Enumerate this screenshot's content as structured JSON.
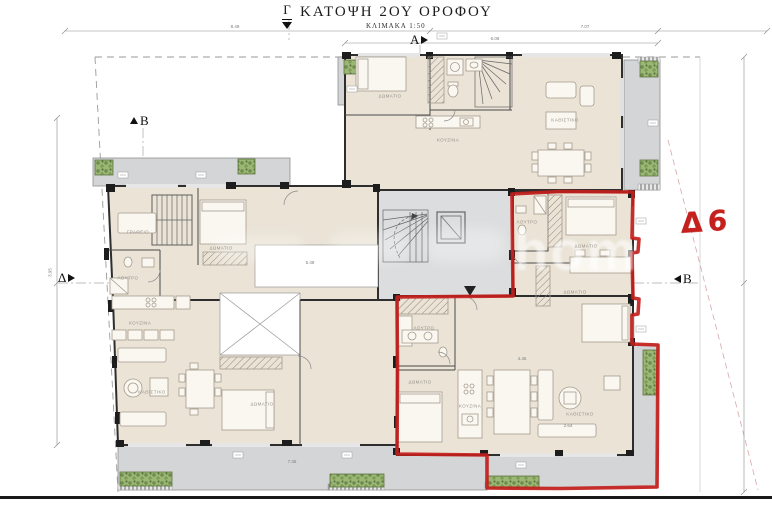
{
  "title": {
    "main": "ΚΑΤΟΨΗ 2ΟΥ ΟΡΟΦΟΥ",
    "scale": "ΚΛΙΜΑΚΑ 1:50"
  },
  "unit_label": "Δ6",
  "watermark": "home",
  "colors": {
    "highlight": "#c4201d",
    "floor": "#eae3d6",
    "balcony": "#d3d5d7",
    "hall": "#dcddde",
    "planter": "#9ab873",
    "wall": "#2e2e2e",
    "boundary": "#9a9a9a"
  },
  "section_markers": [
    {
      "label": "Γ",
      "dir": "down"
    },
    {
      "label": "Α",
      "dir": "right"
    },
    {
      "label": "Β",
      "dir": "up"
    },
    {
      "label": "Δ",
      "dir": "right"
    },
    {
      "label": "Β",
      "dir": "left"
    }
  ],
  "plan": {
    "rooms": [
      {
        "label": "ΔΩΜΑΤΙΟ",
        "x": 390,
        "y": 96
      },
      {
        "label": "ΚΟΥΖΙΝΑ",
        "x": 448,
        "y": 140
      },
      {
        "label": "ΚΑΘΙΣΤΙΚΟ",
        "x": 565,
        "y": 120
      },
      {
        "label": "ΓΡΑΦΕΙΟ",
        "x": 138,
        "y": 232
      },
      {
        "label": "ΔΩΜΑΤΙΟ",
        "x": 221,
        "y": 248
      },
      {
        "label": "ΛΟΥΤΡΟ",
        "x": 128,
        "y": 278
      },
      {
        "label": "ΚΟΥΖΙΝΑ",
        "x": 140,
        "y": 323
      },
      {
        "label": "ΚΑΘΙΣΤΙΚΟ",
        "x": 152,
        "y": 392
      },
      {
        "label": "ΔΩΜΑΤΙΟ",
        "x": 262,
        "y": 404
      },
      {
        "label": "ΛΟΥΤΡΟ",
        "x": 527,
        "y": 222
      },
      {
        "label": "ΔΩΜΑΤΙΟ",
        "x": 586,
        "y": 246
      },
      {
        "label": "ΔΩΜΑΤΙΟ",
        "x": 575,
        "y": 292
      },
      {
        "label": "ΛΟΥΤΡΟ",
        "x": 424,
        "y": 328
      },
      {
        "label": "ΔΩΜΑΤΙΟ",
        "x": 420,
        "y": 382
      },
      {
        "label": "ΚΟΥΖΙΝΑ",
        "x": 470,
        "y": 406
      },
      {
        "label": "ΚΑΘΙΣΤΙΚΟ",
        "x": 580,
        "y": 414
      }
    ],
    "dims": [
      {
        "v": "8.49",
        "x": 235,
        "y": 29
      },
      {
        "v": "7.07",
        "x": 585,
        "y": 29
      },
      {
        "v": "6.08",
        "x": 495,
        "y": 41
      },
      {
        "v": "5.48",
        "x": 310,
        "y": 265
      },
      {
        "v": "4.45",
        "x": 522,
        "y": 361
      },
      {
        "v": "7.36",
        "x": 292,
        "y": 464
      },
      {
        "v": "2.64",
        "x": 568,
        "y": 428
      },
      {
        "v": "3.95",
        "x": 50,
        "y": 275,
        "rot": -90
      }
    ]
  }
}
